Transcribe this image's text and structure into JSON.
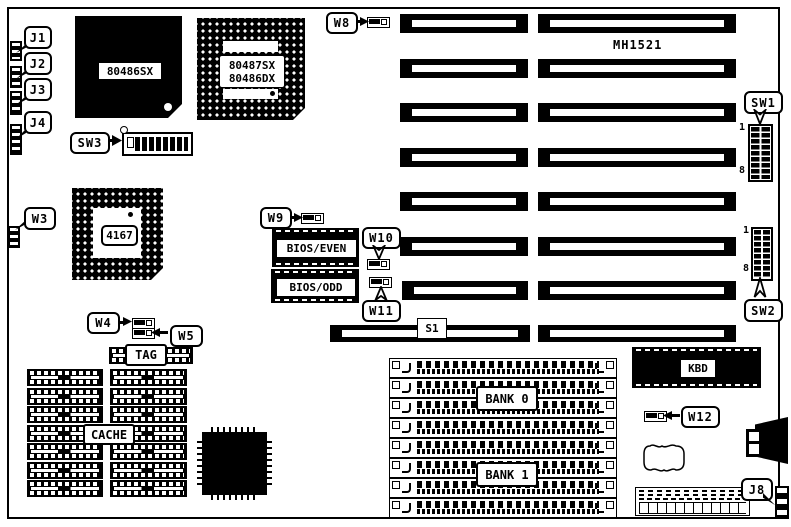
{
  "board": {
    "model": "MH1521"
  },
  "processors": {
    "cpu_label": "80486SX",
    "copro_line1": "80487SX",
    "copro_line2": "80486DX",
    "chipset_label": "4167"
  },
  "memory": {
    "bank0_label": "BANK 0",
    "bank1_label": "BANK 1",
    "tag_label": "TAG",
    "cache_label": "CACHE"
  },
  "rom": {
    "bios_even_label": "BIOS/EVEN",
    "bios_odd_label": "BIOS/ODD",
    "kbd_label": "KBD"
  },
  "connectors": {
    "j1": "J1",
    "j2": "J2",
    "j3": "J3",
    "j4": "J4",
    "j8": "J8",
    "s1": "S1"
  },
  "jumpers": {
    "w3": "W3",
    "w4": "W4",
    "w5": "W5",
    "w8": "W8",
    "w9": "W9",
    "w10": "W10",
    "w11": "W11",
    "w12": "W12"
  },
  "switches": {
    "sw1": "SW1",
    "sw2": "SW2",
    "sw3": "SW3",
    "pin_first": "1",
    "pin_last": "8"
  },
  "colors": {
    "ink": "#000000",
    "paper": "#ffffff"
  }
}
